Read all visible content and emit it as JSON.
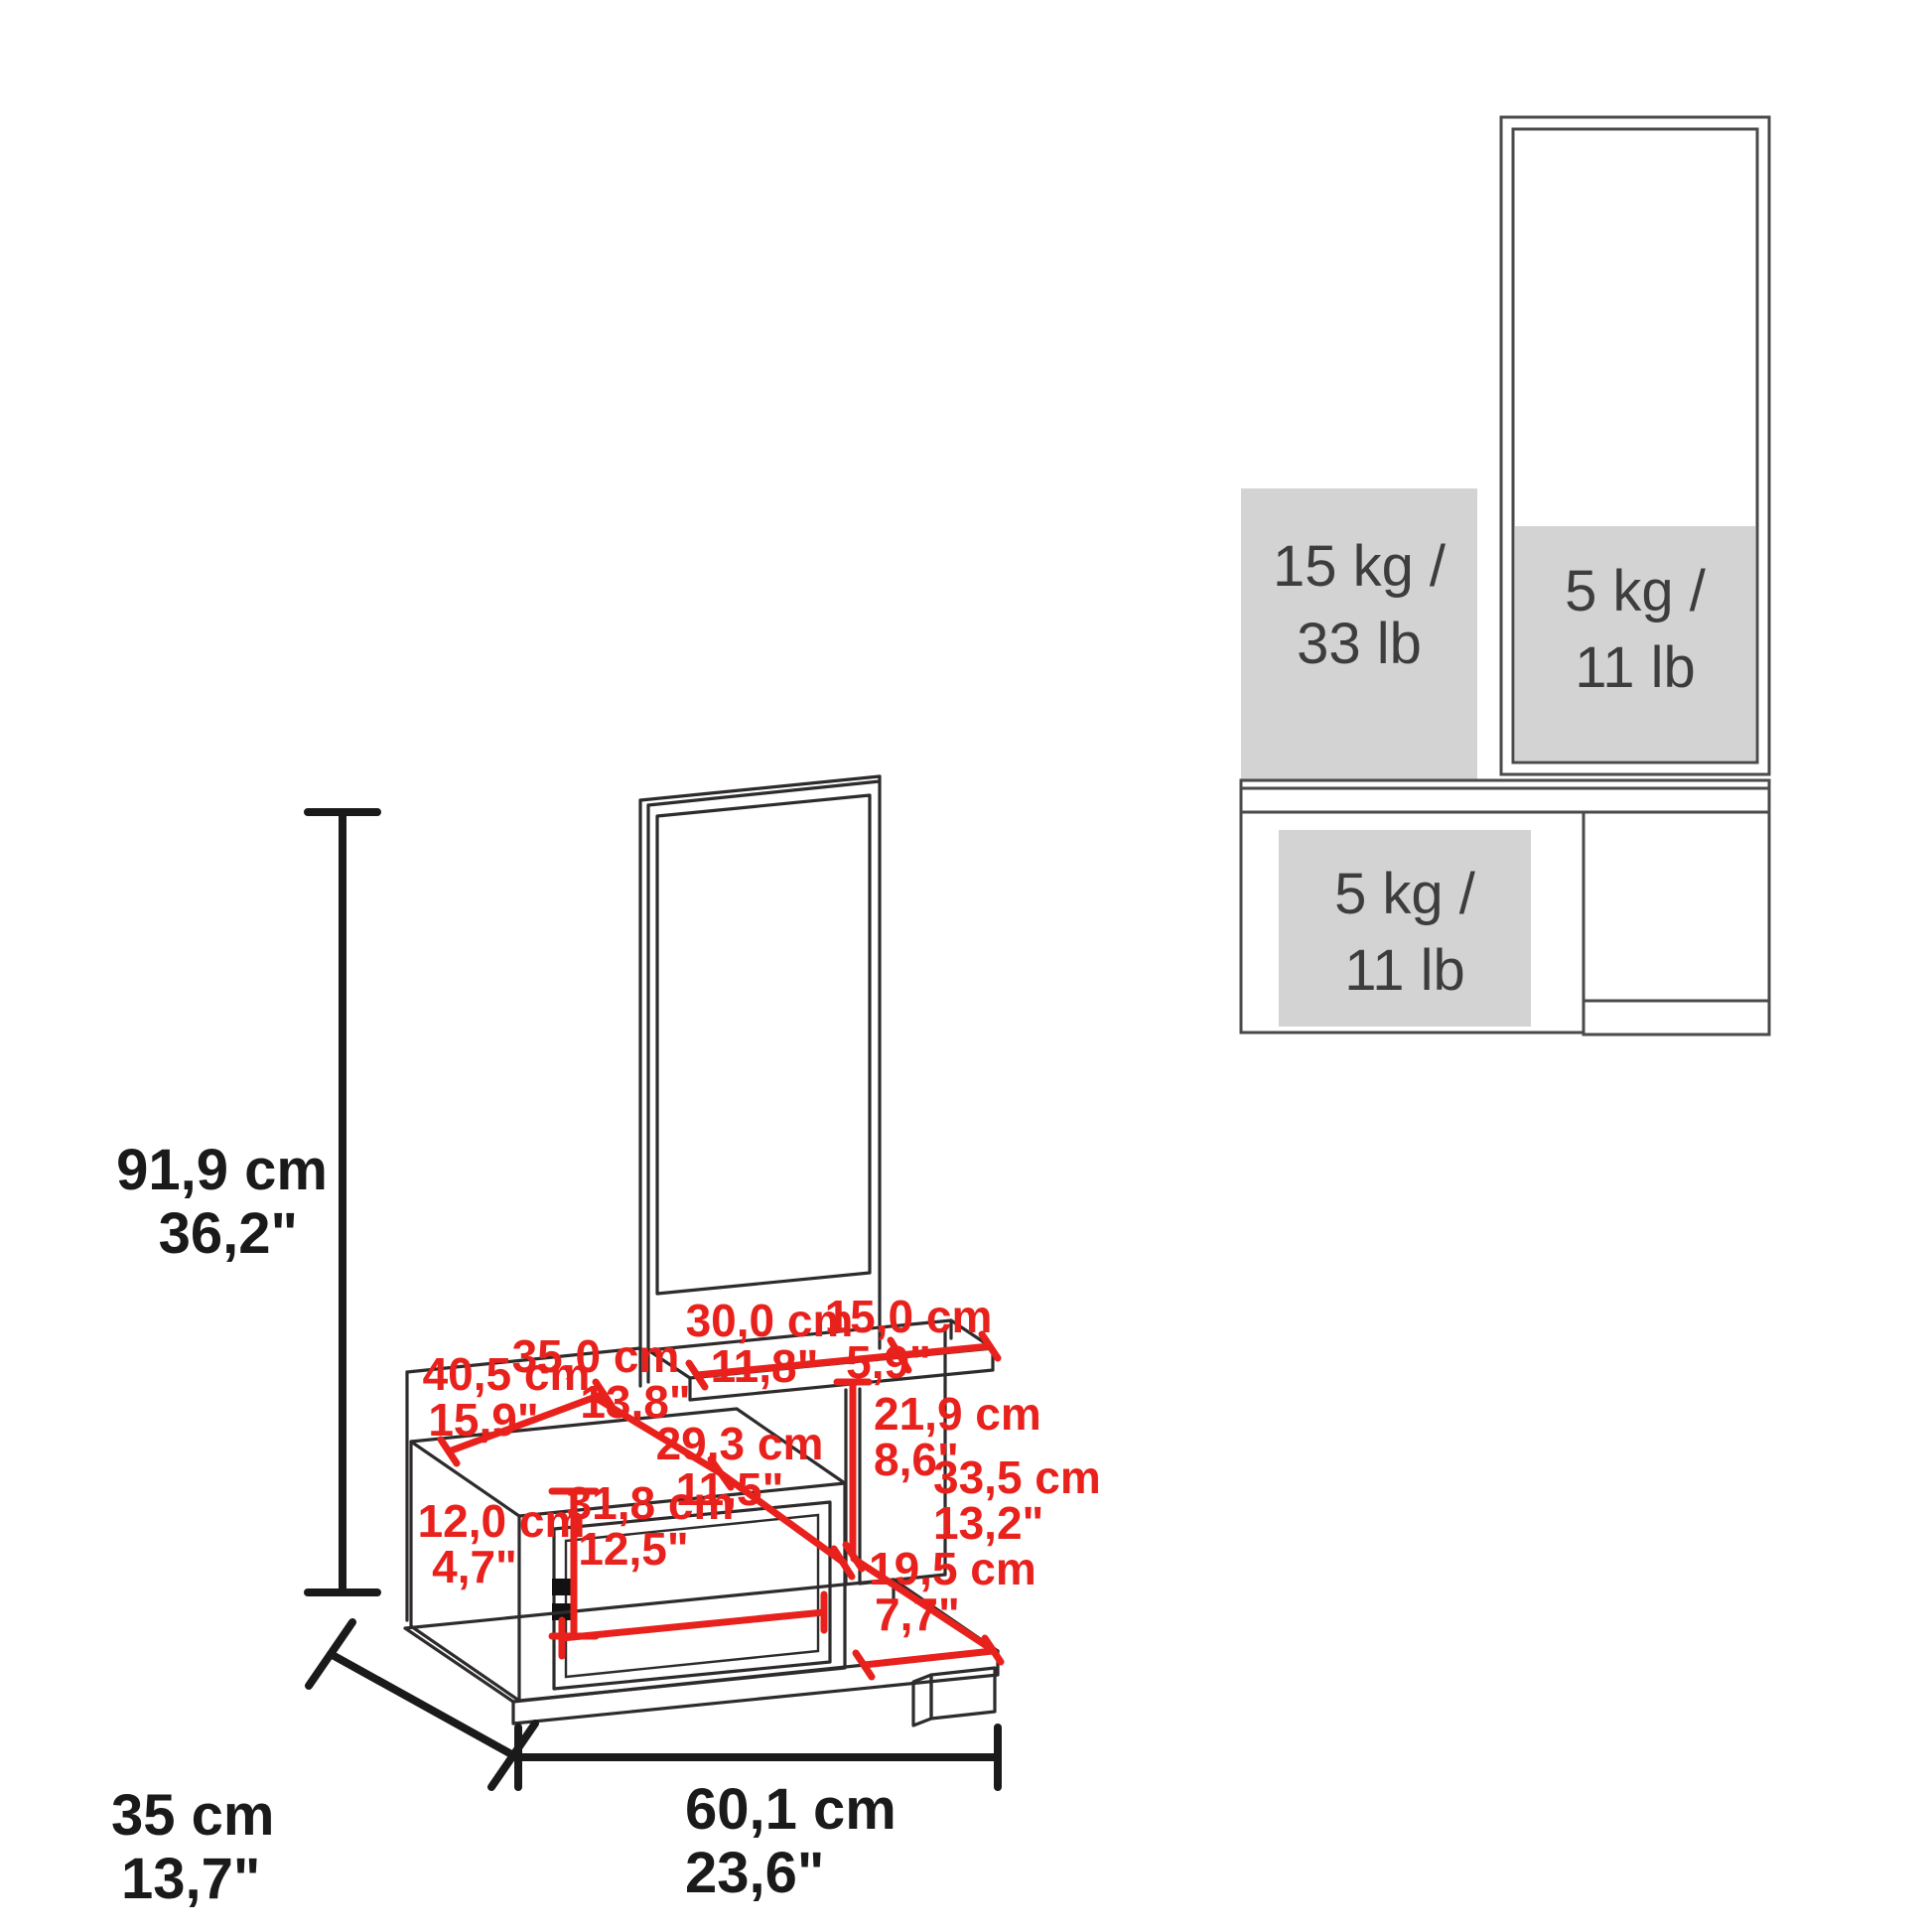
{
  "diagram_type": "furniture-dimension-and-load-capacity-diagram",
  "colors": {
    "dimension_red": "#e8211d",
    "line_black": "#2e2b2c",
    "capacity_gray_fill": "#d3d3d3",
    "capacity_text": "#3d3d3d",
    "background": "#ffffff"
  },
  "left_diagram": {
    "name": "isometric-dimensioned-view",
    "overall": {
      "height": {
        "metric": "91,9 cm",
        "imperial": "36,2\""
      },
      "depth": {
        "metric": "35 cm",
        "imperial": "13,7\""
      },
      "width": {
        "metric": "60,1 cm",
        "imperial": "23,6\""
      }
    },
    "part_dimensions": [
      {
        "id": "shelf-left-span",
        "metric": "30,0 cm",
        "imperial": "11,8\""
      },
      {
        "id": "shelf-right-span",
        "metric": "15,0 cm",
        "imperial": "5,9\""
      },
      {
        "id": "top-surface-depth",
        "metric": "40,5 cm",
        "imperial": "15,9\""
      },
      {
        "id": "top-surface-width",
        "metric": "35,0 cm",
        "imperial": "13,8\""
      },
      {
        "id": "open-compartment-width",
        "metric": "29,3 cm",
        "imperial": "11,5\""
      },
      {
        "id": "compartment-height",
        "metric": "21,9 cm",
        "imperial": "8,6\""
      },
      {
        "id": "base-right-depth",
        "metric": "33,5 cm",
        "imperial": "13,2\""
      },
      {
        "id": "drawer-front-height",
        "metric": "12,0 cm",
        "imperial": "4,7\""
      },
      {
        "id": "drawer-front-width",
        "metric": "31,8 cm",
        "imperial": "12,5\""
      },
      {
        "id": "base-front-right-span",
        "metric": "19,5 cm",
        "imperial": "7,7\""
      }
    ]
  },
  "right_diagram": {
    "name": "front-view-load-capacity",
    "capacities": [
      {
        "id": "mirror-shelf-capacity",
        "kg": "5 kg /",
        "lb": "11 lb"
      },
      {
        "id": "upper-shelf-capacity",
        "kg": "15 kg /",
        "lb": "33 lb"
      },
      {
        "id": "cabinet-capacity",
        "kg": "5 kg /",
        "lb": "11 lb"
      }
    ]
  }
}
